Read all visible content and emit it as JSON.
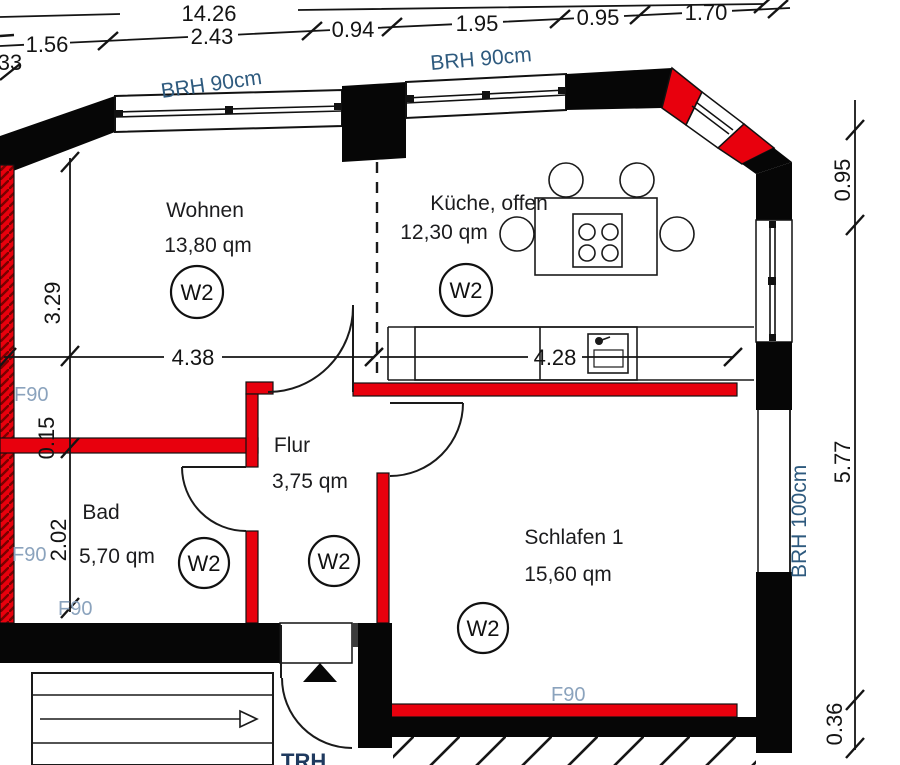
{
  "plan": {
    "rooms": [
      {
        "name": "Wohnen",
        "area": "13,80 qm",
        "unit_tag": "W2"
      },
      {
        "name": "Küche, offen",
        "area": "12,30 qm",
        "unit_tag": "W2"
      },
      {
        "name": "Flur",
        "area": "3,75 qm",
        "unit_tag": "W2"
      },
      {
        "name": "Bad",
        "area": "5,70 qm",
        "unit_tag": "W2"
      },
      {
        "name": "Schlafen 1",
        "area": "15,60 qm",
        "unit_tag": "W2"
      }
    ],
    "dims": {
      "total_top": "14.26",
      "top": [
        "1.56",
        "2.43",
        "0.94",
        "1.95",
        "0.95",
        "1.70"
      ],
      "left": [
        "3.29",
        "0.15",
        "2.02"
      ],
      "right": [
        "0.95",
        "5.77",
        "0.36"
      ],
      "inner": [
        "4.38",
        "4.28"
      ],
      "edge_partial": "33"
    },
    "labels": {
      "window_sill_1": "BRH 90cm",
      "window_sill_2": "BRH 90cm",
      "window_sill_3": "BRH 100cm",
      "fire_rating": "F90",
      "stairwell": "TRH"
    },
    "colors": {
      "wall_red": "#e8000d",
      "hatch_red": "#7a0000",
      "label_blue": "#8ba3bd",
      "sill_blue": "#2e5a7e",
      "stair_blue": "#1f3a5f"
    }
  }
}
